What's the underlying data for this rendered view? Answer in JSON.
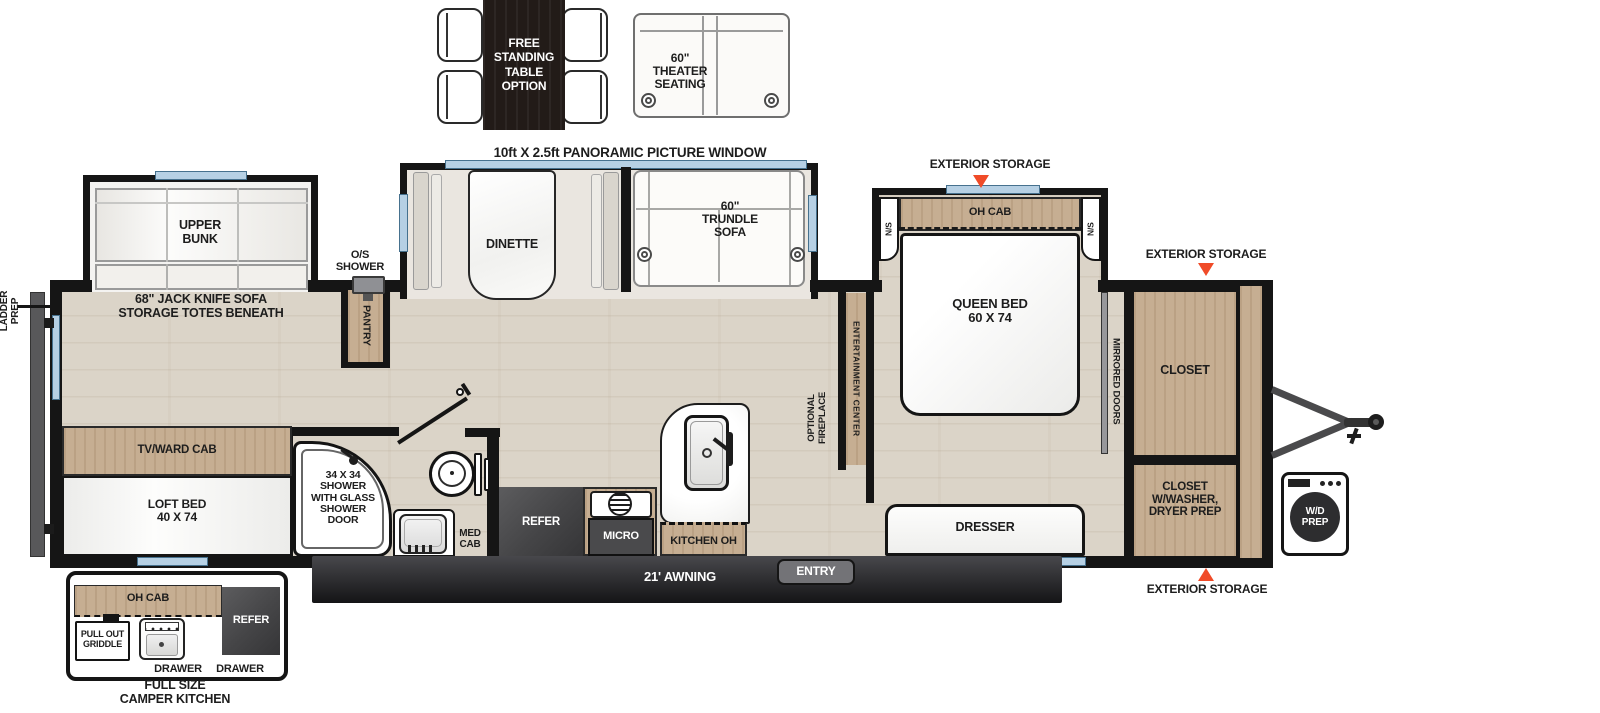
{
  "options": {
    "free_standing_table": "FREE\nSTANDING\nTABLE\nOPTION",
    "theater_seating": "60\"\nTHEATER\nSEATING"
  },
  "callouts": {
    "panoramic_window": "10ft X 2.5ft PANORAMIC PICTURE WINDOW",
    "exterior_storage_bedroom": "EXTERIOR STORAGE",
    "exterior_storage_front_top": "EXTERIOR STORAGE",
    "exterior_storage_front_bottom": "EXTERIOR STORAGE",
    "ladder_prep": "LADDER\nPREP",
    "awning": "21' AWNING",
    "entry": "ENTRY"
  },
  "rear": {
    "upper_bunk": "UPPER\nBUNK",
    "jack_knife_sofa": "68\" JACK KNIFE SOFA\nSTORAGE TOTES BENEATH",
    "tv_ward_cab": "TV/WARD CAB",
    "loft_bed": "LOFT BED\n40 X 74"
  },
  "bath": {
    "os_shower": "O/S\nSHOWER",
    "pantry": "PANTRY",
    "shower": "34 X 34\nSHOWER\nWITH GLASS\nSHOWER\nDOOR",
    "med_cab": "MED\nCAB"
  },
  "kitchen": {
    "refer": "REFER",
    "micro": "MICRO",
    "kitchen_oh": "KITCHEN OH"
  },
  "living": {
    "dinette": "DINETTE",
    "trundle_sofa": "60\"\nTRUNDLE\nSOFA",
    "entertainment_center": "ENTERTAINMENT CENTER",
    "optional_fireplace": "OPTIONAL\nFIREPLACE"
  },
  "bedroom": {
    "oh_cab": "OH CAB",
    "ns_left": "N/S",
    "ns_right": "N/S",
    "queen_bed": "QUEEN BED\n60 X 74",
    "dresser": "DRESSER",
    "mirrored_doors": "MIRRORED DOORS"
  },
  "front": {
    "closet": "CLOSET",
    "closet_washer": "CLOSET\nW/WASHER,\nDRYER PREP",
    "wd_prep": "W/D\nPREP"
  },
  "camper_kitchen": {
    "title": "FULL SIZE\nCAMPER KITCHEN",
    "oh_cab": "OH CAB",
    "pull_out_griddle": "PULL OUT\nGRIDDLE",
    "refer": "REFER",
    "drawer_left": "DRAWER",
    "drawer_right": "DRAWER"
  },
  "colors": {
    "wall": "#151515",
    "wood": "#c6ae92",
    "window": "#b6d0e4",
    "accent": "#f04b28",
    "appliance_dark": "#47474a",
    "awning_bar": "#2b2b2d"
  }
}
